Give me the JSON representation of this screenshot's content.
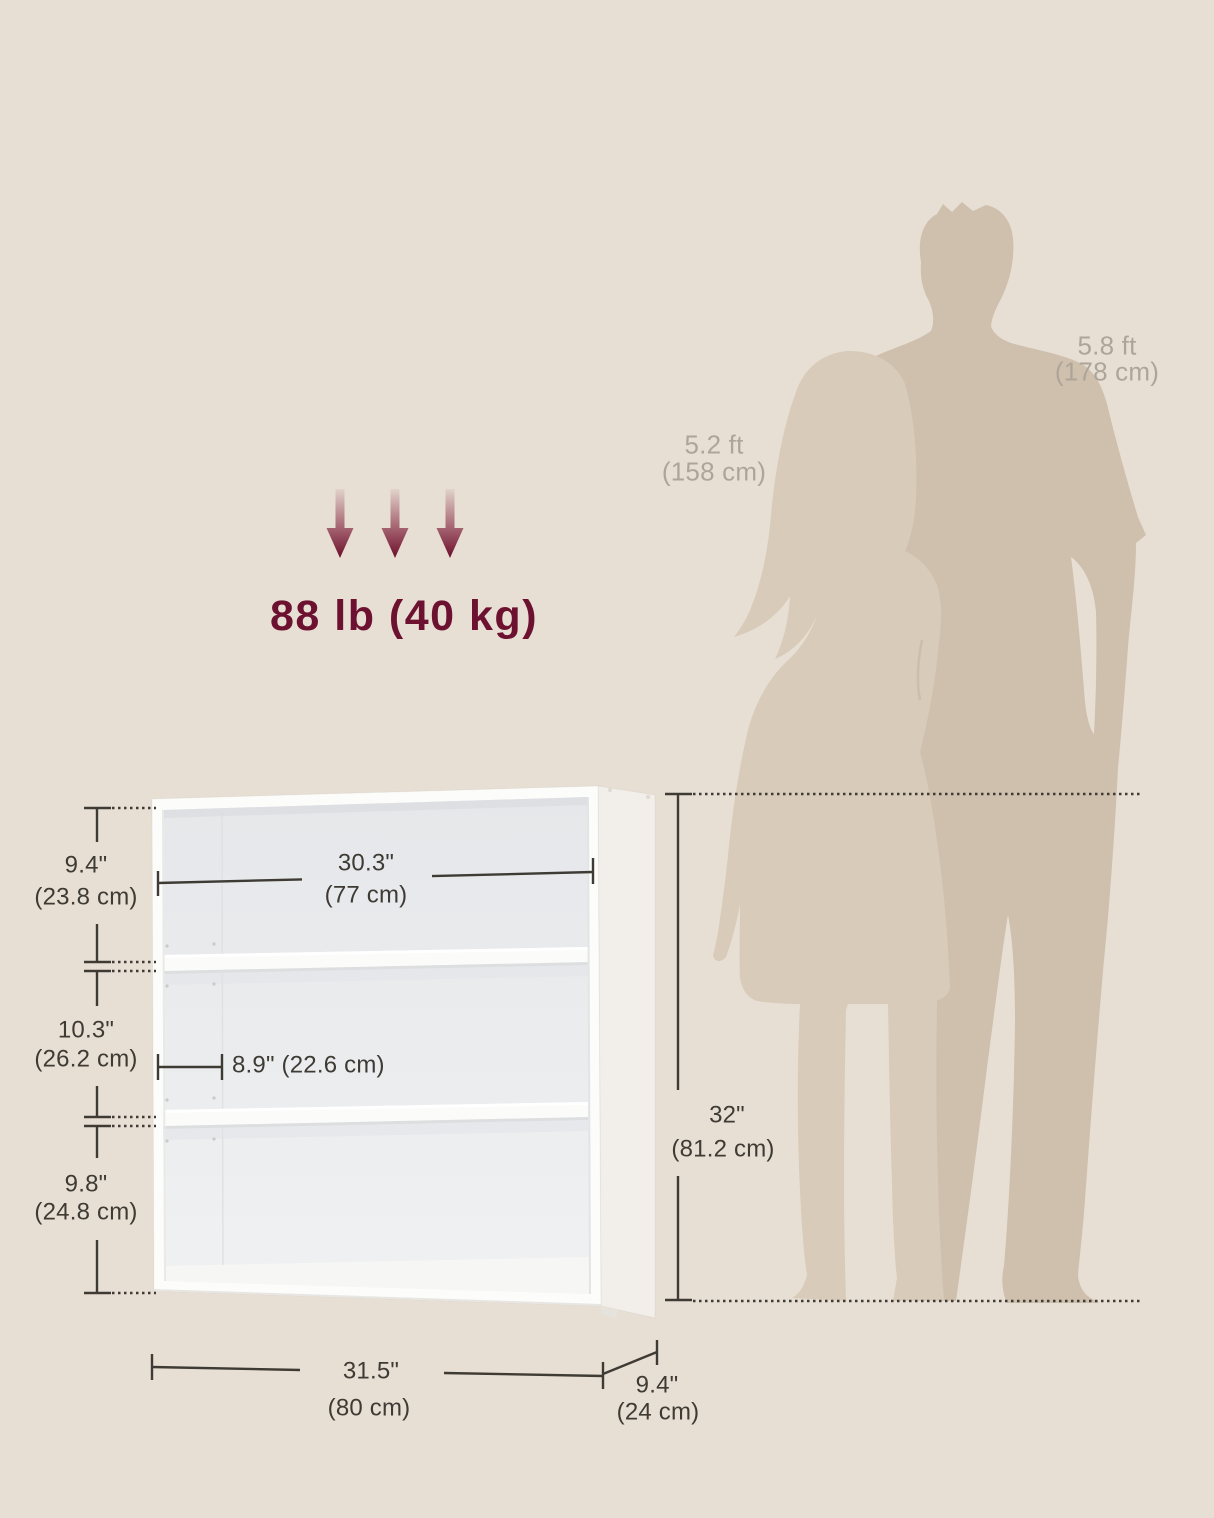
{
  "diagram_title": "bookshelf-dimension-diagram",
  "colors": {
    "background": "#e8dfd4",
    "accent_maroon": "#6d1130",
    "dimension_line": "#3e3a34",
    "silhouette_man": "#cfc0ae",
    "silhouette_woman": "#d8cbba",
    "height_label_gray": "#ada698"
  },
  "weight_capacity": {
    "label": "88 lb (40 kg)"
  },
  "people": {
    "woman": {
      "ft": "5.2 ft",
      "cm": "(158 cm)"
    },
    "man": {
      "ft": "5.8 ft",
      "cm": "(178 cm)"
    }
  },
  "dims": {
    "top_compartment": {
      "in": "9.4\"",
      "cm": "(23.8 cm)"
    },
    "inner_width": {
      "in": "30.3\"",
      "cm": "(77 cm)"
    },
    "middle_compartment": {
      "in": "10.3\"",
      "cm": "(26.2 cm)"
    },
    "inner_depth": {
      "label": "8.9\" (22.6 cm)"
    },
    "bottom_compartment": {
      "in": "9.8\"",
      "cm": "(24.8 cm)"
    },
    "overall_height": {
      "in": "32\"",
      "cm": "(81.2 cm)"
    },
    "overall_width": {
      "in": "31.5\"",
      "cm": "(80 cm)"
    },
    "overall_depth": {
      "in": "9.4\"",
      "cm": "(24 cm)"
    }
  }
}
